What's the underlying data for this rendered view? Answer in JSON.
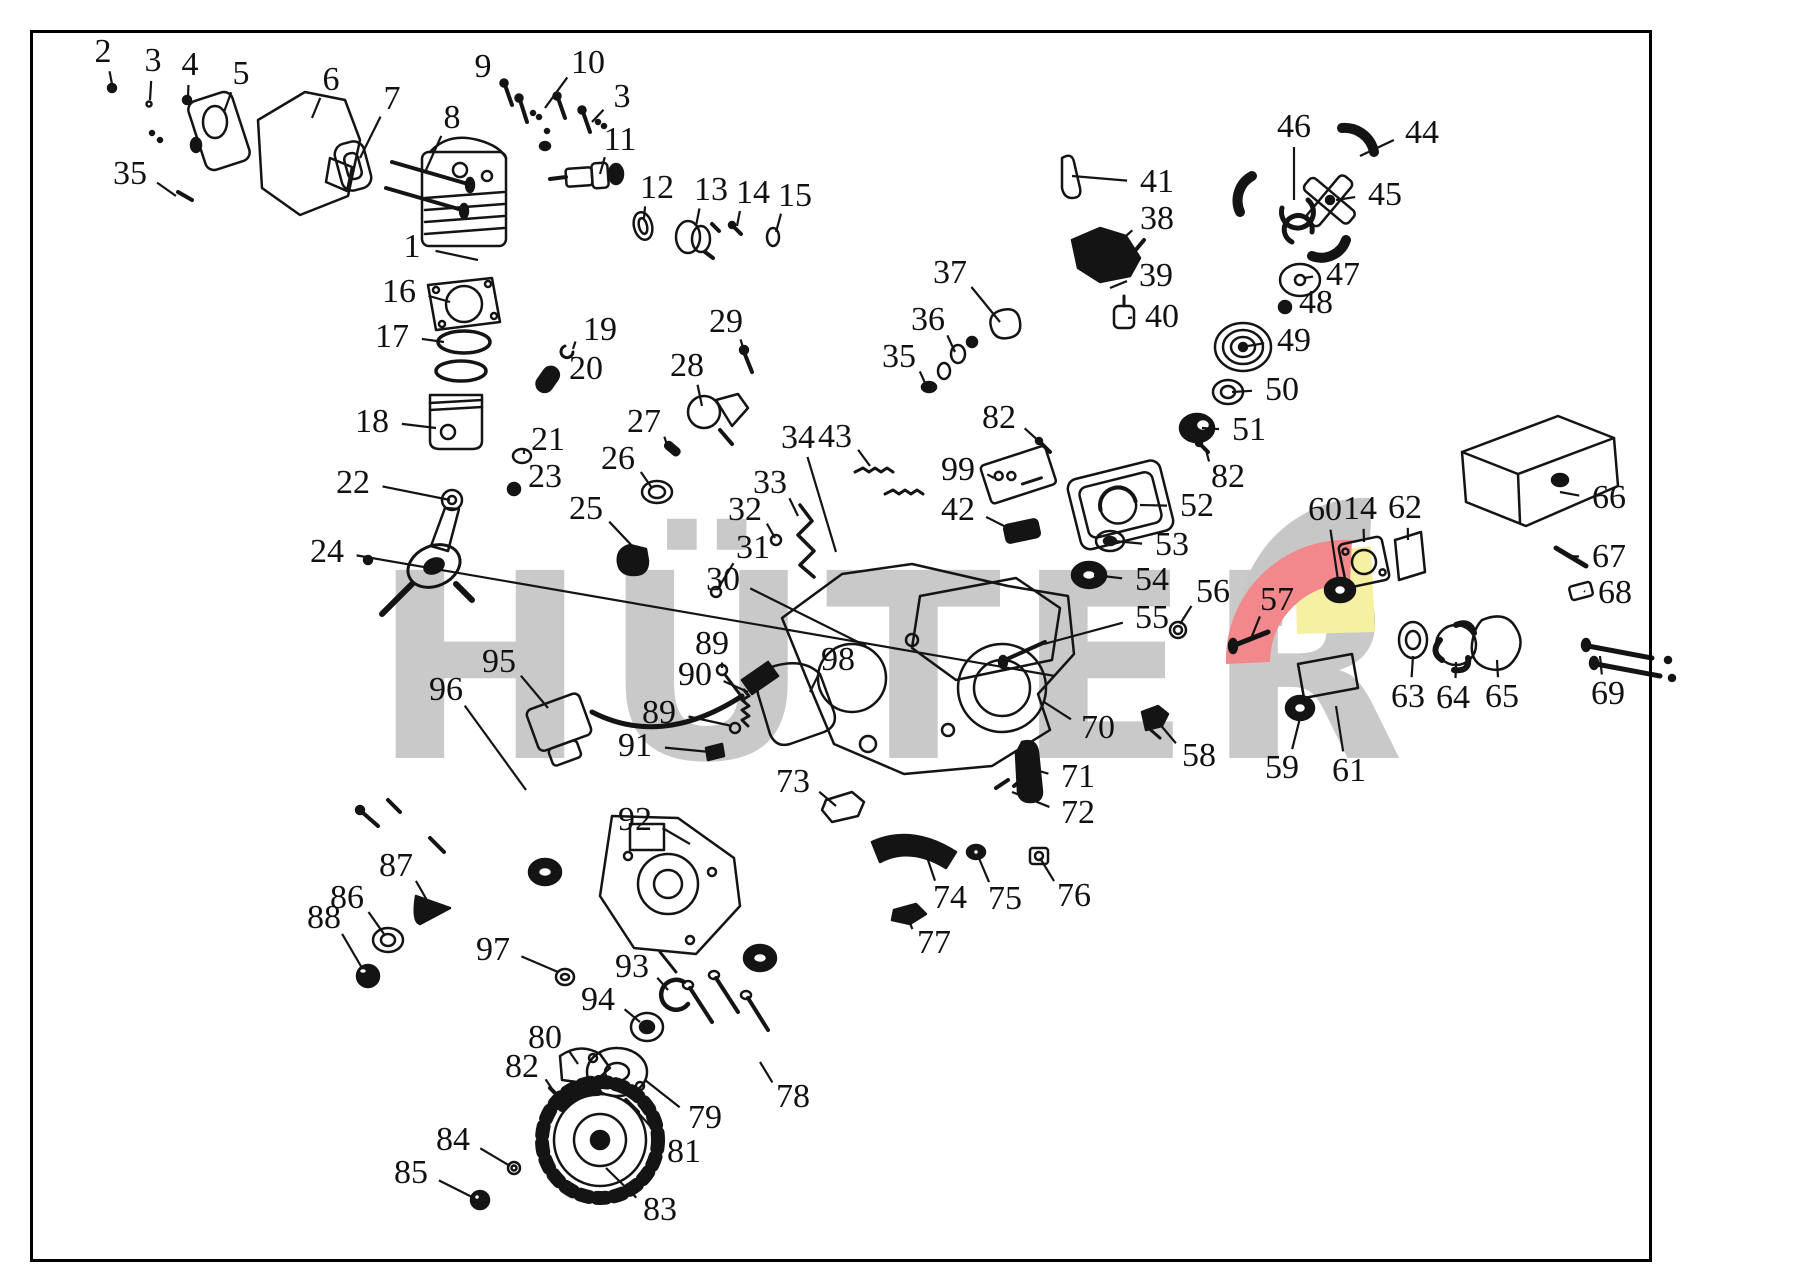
{
  "watermark": {
    "text": "HÜTER",
    "color": "#c9c9c9"
  },
  "logo": {
    "gray": "#c7c7c7",
    "red": "#f2888c",
    "yellow": "#f6f0a3"
  },
  "ink": "#141414",
  "callouts": [
    {
      "n": "1",
      "x": 412,
      "y": 247,
      "tx": 478,
      "ty": 260
    },
    {
      "n": "2",
      "x": 103,
      "y": 52,
      "tx": 112,
      "ty": 84
    },
    {
      "n": "3",
      "x": 153,
      "y": 61,
      "tx": 150,
      "ty": 100
    },
    {
      "n": "4",
      "x": 190,
      "y": 65,
      "tx": 188,
      "ty": 96
    },
    {
      "n": "5",
      "x": 241,
      "y": 74,
      "tx": 224,
      "ty": 112
    },
    {
      "n": "6",
      "x": 331,
      "y": 80,
      "tx": 312,
      "ty": 118
    },
    {
      "n": "7",
      "x": 392,
      "y": 99,
      "tx": 360,
      "ty": 158
    },
    {
      "n": "8",
      "x": 452,
      "y": 118,
      "tx": 426,
      "ty": 170
    },
    {
      "n": "9",
      "x": 483,
      "y": 67,
      "tx": 508,
      "ty": 90
    },
    {
      "n": "10",
      "x": 588,
      "y": 63,
      "tx": 545,
      "ty": 108
    },
    {
      "n": "3",
      "x": 622,
      "y": 97,
      "tx": 592,
      "ty": 122
    },
    {
      "n": "11",
      "x": 620,
      "y": 140,
      "tx": 600,
      "ty": 174
    },
    {
      "n": "12",
      "x": 657,
      "y": 188,
      "tx": 644,
      "ty": 218
    },
    {
      "n": "13",
      "x": 711,
      "y": 190,
      "tx": 696,
      "ty": 226
    },
    {
      "n": "14",
      "x": 753,
      "y": 193,
      "tx": 737,
      "ty": 226
    },
    {
      "n": "15",
      "x": 795,
      "y": 196,
      "tx": 776,
      "ty": 232
    },
    {
      "n": "16",
      "x": 399,
      "y": 292,
      "tx": 450,
      "ty": 302
    },
    {
      "n": "17",
      "x": 392,
      "y": 337,
      "tx": 444,
      "ty": 342
    },
    {
      "n": "18",
      "x": 372,
      "y": 422,
      "tx": 436,
      "ty": 428
    },
    {
      "n": "19",
      "x": 600,
      "y": 330,
      "tx": 573,
      "ty": 349
    },
    {
      "n": "20",
      "x": 586,
      "y": 369,
      "tx": 556,
      "ty": 377
    },
    {
      "n": "21",
      "x": 548,
      "y": 440,
      "tx": 524,
      "ty": 454
    },
    {
      "n": "22",
      "x": 353,
      "y": 483,
      "tx": 450,
      "ty": 500
    },
    {
      "n": "23",
      "x": 545,
      "y": 477,
      "tx": 517,
      "ty": 487
    },
    {
      "n": "24",
      "x": 327,
      "y": 552,
      "tx": 1055,
      "ty": 676
    },
    {
      "n": "25",
      "x": 586,
      "y": 509,
      "tx": 636,
      "ty": 550
    },
    {
      "n": "26",
      "x": 618,
      "y": 459,
      "tx": 652,
      "ty": 488
    },
    {
      "n": "27",
      "x": 644,
      "y": 422,
      "tx": 668,
      "ty": 448
    },
    {
      "n": "28",
      "x": 687,
      "y": 366,
      "tx": 702,
      "ty": 406
    },
    {
      "n": "29",
      "x": 726,
      "y": 322,
      "tx": 746,
      "ty": 358
    },
    {
      "n": "30",
      "x": 723,
      "y": 580,
      "tx": 866,
      "ty": 646
    },
    {
      "n": "31",
      "x": 753,
      "y": 548,
      "tx": 717,
      "ty": 590
    },
    {
      "n": "32",
      "x": 745,
      "y": 510,
      "tx": 775,
      "ty": 538
    },
    {
      "n": "33",
      "x": 770,
      "y": 483,
      "tx": 798,
      "ty": 516
    },
    {
      "n": "34",
      "x": 798,
      "y": 438,
      "tx": 836,
      "ty": 552
    },
    {
      "n": "35",
      "x": 130,
      "y": 174,
      "tx": 176,
      "ty": 196
    },
    {
      "n": "35",
      "x": 899,
      "y": 357,
      "tx": 926,
      "ty": 385
    },
    {
      "n": "36",
      "x": 928,
      "y": 320,
      "tx": 955,
      "ty": 352
    },
    {
      "n": "37",
      "x": 950,
      "y": 273,
      "tx": 1000,
      "ty": 322
    },
    {
      "n": "38",
      "x": 1157,
      "y": 219,
      "tx": 1106,
      "ty": 254
    },
    {
      "n": "39",
      "x": 1156,
      "y": 276,
      "tx": 1110,
      "ty": 288
    },
    {
      "n": "40",
      "x": 1162,
      "y": 317,
      "tx": 1128,
      "ty": 318
    },
    {
      "n": "41",
      "x": 1157,
      "y": 182,
      "tx": 1072,
      "ty": 176
    },
    {
      "n": "42",
      "x": 958,
      "y": 510,
      "tx": 1012,
      "ty": 530
    },
    {
      "n": "43",
      "x": 835,
      "y": 437,
      "tx": 870,
      "ty": 466
    },
    {
      "n": "44",
      "x": 1422,
      "y": 133,
      "tx": 1360,
      "ty": 156
    },
    {
      "n": "45",
      "x": 1385,
      "y": 195,
      "tx": 1336,
      "ty": 200
    },
    {
      "n": "46",
      "x": 1294,
      "y": 127,
      "tx": 1294,
      "ty": 200
    },
    {
      "n": "47",
      "x": 1343,
      "y": 275,
      "tx": 1304,
      "ty": 278
    },
    {
      "n": "48",
      "x": 1316,
      "y": 303,
      "tx": 1288,
      "ty": 306
    },
    {
      "n": "49",
      "x": 1294,
      "y": 341,
      "tx": 1248,
      "ty": 346
    },
    {
      "n": "50",
      "x": 1282,
      "y": 390,
      "tx": 1232,
      "ty": 392
    },
    {
      "n": "51",
      "x": 1249,
      "y": 430,
      "tx": 1202,
      "ty": 428
    },
    {
      "n": "52",
      "x": 1197,
      "y": 506,
      "tx": 1140,
      "ty": 505
    },
    {
      "n": "53",
      "x": 1172,
      "y": 545,
      "tx": 1114,
      "ty": 541
    },
    {
      "n": "54",
      "x": 1152,
      "y": 580,
      "tx": 1094,
      "ty": 575
    },
    {
      "n": "55",
      "x": 1152,
      "y": 618,
      "tx": 1044,
      "ty": 644
    },
    {
      "n": "56",
      "x": 1213,
      "y": 592,
      "tx": 1180,
      "ty": 624
    },
    {
      "n": "57",
      "x": 1277,
      "y": 600,
      "tx": 1252,
      "ty": 636
    },
    {
      "n": "58",
      "x": 1199,
      "y": 756,
      "tx": 1158,
      "ty": 722
    },
    {
      "n": "59",
      "x": 1282,
      "y": 768,
      "tx": 1300,
      "ty": 718
    },
    {
      "n": "60",
      "x": 1325,
      "y": 510,
      "tx": 1338,
      "ty": 580
    },
    {
      "n": "61",
      "x": 1349,
      "y": 771,
      "tx": 1336,
      "ty": 706
    },
    {
      "n": "14",
      "x": 1360,
      "y": 509,
      "tx": 1364,
      "ty": 542
    },
    {
      "n": "62",
      "x": 1405,
      "y": 508,
      "tx": 1408,
      "ty": 540
    },
    {
      "n": "63",
      "x": 1408,
      "y": 697,
      "tx": 1413,
      "ty": 656
    },
    {
      "n": "64",
      "x": 1453,
      "y": 698,
      "tx": 1456,
      "ty": 662
    },
    {
      "n": "65",
      "x": 1502,
      "y": 697,
      "tx": 1497,
      "ty": 660
    },
    {
      "n": "66",
      "x": 1609,
      "y": 498,
      "tx": 1560,
      "ty": 492
    },
    {
      "n": "67",
      "x": 1609,
      "y": 557,
      "tx": 1566,
      "ty": 556
    },
    {
      "n": "68",
      "x": 1615,
      "y": 593,
      "tx": 1584,
      "ty": 591
    },
    {
      "n": "69",
      "x": 1608,
      "y": 694,
      "tx": 1600,
      "ty": 656
    },
    {
      "n": "70",
      "x": 1098,
      "y": 728,
      "tx": 1044,
      "ty": 702
    },
    {
      "n": "71",
      "x": 1078,
      "y": 777,
      "tx": 1036,
      "ty": 770
    },
    {
      "n": "72",
      "x": 1078,
      "y": 813,
      "tx": 1012,
      "ty": 792
    },
    {
      "n": "73",
      "x": 793,
      "y": 782,
      "tx": 836,
      "ty": 806
    },
    {
      "n": "74",
      "x": 950,
      "y": 898,
      "tx": 928,
      "ty": 860
    },
    {
      "n": "75",
      "x": 1005,
      "y": 899,
      "tx": 978,
      "ty": 856
    },
    {
      "n": "76",
      "x": 1074,
      "y": 896,
      "tx": 1040,
      "ty": 858
    },
    {
      "n": "77",
      "x": 934,
      "y": 943,
      "tx": 908,
      "ty": 918
    },
    {
      "n": "78",
      "x": 793,
      "y": 1097,
      "tx": 760,
      "ty": 1062
    },
    {
      "n": "79",
      "x": 705,
      "y": 1118,
      "tx": 645,
      "ty": 1080
    },
    {
      "n": "80",
      "x": 545,
      "y": 1038,
      "tx": 578,
      "ty": 1064
    },
    {
      "n": "81",
      "x": 684,
      "y": 1152,
      "tx": 634,
      "ty": 1108
    },
    {
      "n": "82",
      "x": 999,
      "y": 418,
      "tx": 1042,
      "ty": 444
    },
    {
      "n": "82",
      "x": 1228,
      "y": 477,
      "tx": 1206,
      "ty": 450
    },
    {
      "n": "82",
      "x": 522,
      "y": 1067,
      "tx": 554,
      "ty": 1092
    },
    {
      "n": "83",
      "x": 660,
      "y": 1210,
      "tx": 606,
      "ty": 1168
    },
    {
      "n": "84",
      "x": 453,
      "y": 1140,
      "tx": 510,
      "ty": 1166
    },
    {
      "n": "85",
      "x": 411,
      "y": 1173,
      "tx": 474,
      "ty": 1198
    },
    {
      "n": "86",
      "x": 347,
      "y": 898,
      "tx": 384,
      "ty": 934
    },
    {
      "n": "87",
      "x": 396,
      "y": 866,
      "tx": 428,
      "ty": 902
    },
    {
      "n": "88",
      "x": 324,
      "y": 918,
      "tx": 362,
      "ty": 968
    },
    {
      "n": "89",
      "x": 712,
      "y": 644,
      "tx": 722,
      "ty": 668
    },
    {
      "n": "89",
      "x": 659,
      "y": 713,
      "tx": 732,
      "ty": 726
    },
    {
      "n": "90",
      "x": 695,
      "y": 675,
      "tx": 748,
      "ty": 692
    },
    {
      "n": "91",
      "x": 635,
      "y": 746,
      "tx": 710,
      "ty": 752
    },
    {
      "n": "92",
      "x": 635,
      "y": 820,
      "tx": 690,
      "ty": 844
    },
    {
      "n": "93",
      "x": 632,
      "y": 967,
      "tx": 668,
      "ty": 990
    },
    {
      "n": "94",
      "x": 598,
      "y": 1000,
      "tx": 640,
      "ty": 1022
    },
    {
      "n": "95",
      "x": 499,
      "y": 662,
      "tx": 548,
      "ty": 708
    },
    {
      "n": "96",
      "x": 446,
      "y": 690,
      "tx": 526,
      "ty": 790
    },
    {
      "n": "97",
      "x": 493,
      "y": 950,
      "tx": 558,
      "ty": 972
    },
    {
      "n": "98",
      "x": 838,
      "y": 660,
      "tx": 810,
      "ty": 692
    },
    {
      "n": "99",
      "x": 958,
      "y": 470,
      "tx": 994,
      "ty": 478
    }
  ]
}
